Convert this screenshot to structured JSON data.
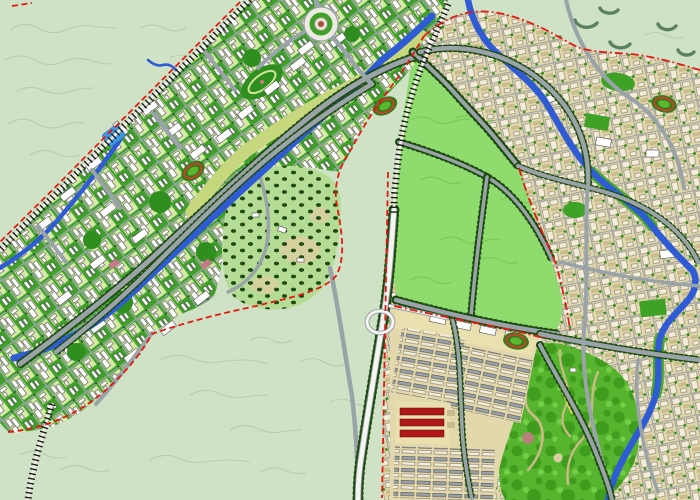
{
  "map": {
    "kind": "city-master-plan-rendering",
    "description": "Master plan map of a new town: a diagonal urban corridor with a river and canal in the north-west, a large reserved green parcel in the centre bounded by tree-lined roads, a dense existing town with a meandering river on the east, a hillside villa quarter, a southern district with row housing and three red warehouse rows, and a large bright-green city park in the south-east. Railways are drawn as black hatched lines and planning boundaries as red dashed and dash-dot lines. No text labels are legible on the map.",
    "regions": [
      {
        "name": "open-terrain",
        "desc": "pale green hills with faint contour lines"
      },
      {
        "name": "new-town-corridor",
        "desc": "diagonal street grid with white buildings, lawns and a central canal"
      },
      {
        "name": "central-reserve",
        "desc": "large light-green reserved land bounded by tree-lined roads and red boundary"
      },
      {
        "name": "villa-hill",
        "desc": "low-density hillside plots dotted with dark trees"
      },
      {
        "name": "old-town",
        "desc": "dense beige building fabric along a winding blue river"
      },
      {
        "name": "south-district",
        "desc": "row-housing blocks including three long red buildings"
      },
      {
        "name": "city-park",
        "desc": "bright green park with winding footpaths and garden features"
      }
    ],
    "features": [
      {
        "name": "railway",
        "style": "black hatched line"
      },
      {
        "name": "planning-boundary",
        "style": "red dashed / dash-dot line"
      },
      {
        "name": "river",
        "style": "blue winding band with green or tan banks"
      },
      {
        "name": "expressway",
        "style": "white road with loop interchange"
      },
      {
        "name": "tree-lined-road",
        "style": "gray road edged with dark green tree dots"
      },
      {
        "name": "stadium",
        "count": 4
      },
      {
        "name": "roundabout-plaza",
        "count": 1
      },
      {
        "name": "lake",
        "count": 1
      }
    ]
  },
  "colors": {
    "terrain": "#cfe2c5",
    "contour": "#b5cfa9",
    "scrub": "#5a8160",
    "urban_green": "#3da226",
    "deep_green": "#2f8f1e",
    "block_lawn": "#d6e9a6",
    "tree_dark": "#1c4a10",
    "reserve": "#8fdb6d",
    "reserve_line": "#7cc95c",
    "park": "#57b42e",
    "park_tree": "#3f9c1d",
    "park_light": "#74cf46",
    "park_path": "#cbb98a",
    "yellow_path": "#d6d650",
    "villa": "#b4dc94",
    "sand": "#d9cfa0",
    "beige": "#e3d8ac",
    "plaza": "#eadfae",
    "road": "#9aa3a8",
    "road_white": "#f4f4f0",
    "road_casing": "#8b9298",
    "river": "#2f5bd4",
    "riverbank": "#c6d77e",
    "river_green": "#49a82a",
    "lake": "#3f97dc",
    "rail_base": "#f0efe8",
    "rail_tick": "#1b1b1b",
    "boundary": "#e41a12",
    "bld_white": "#ffffff",
    "bld_shadow": "#4d4d4d",
    "bld_beige": "#f2ecd8",
    "bld_tan": "#c9bd90",
    "bld_gray": "#9aa1a8",
    "bld_red": "#b01818",
    "pink_block": "#c87888",
    "track": "#b34a2c",
    "field": "#5ab82f",
    "stadium_rim": "#2d7c18"
  }
}
